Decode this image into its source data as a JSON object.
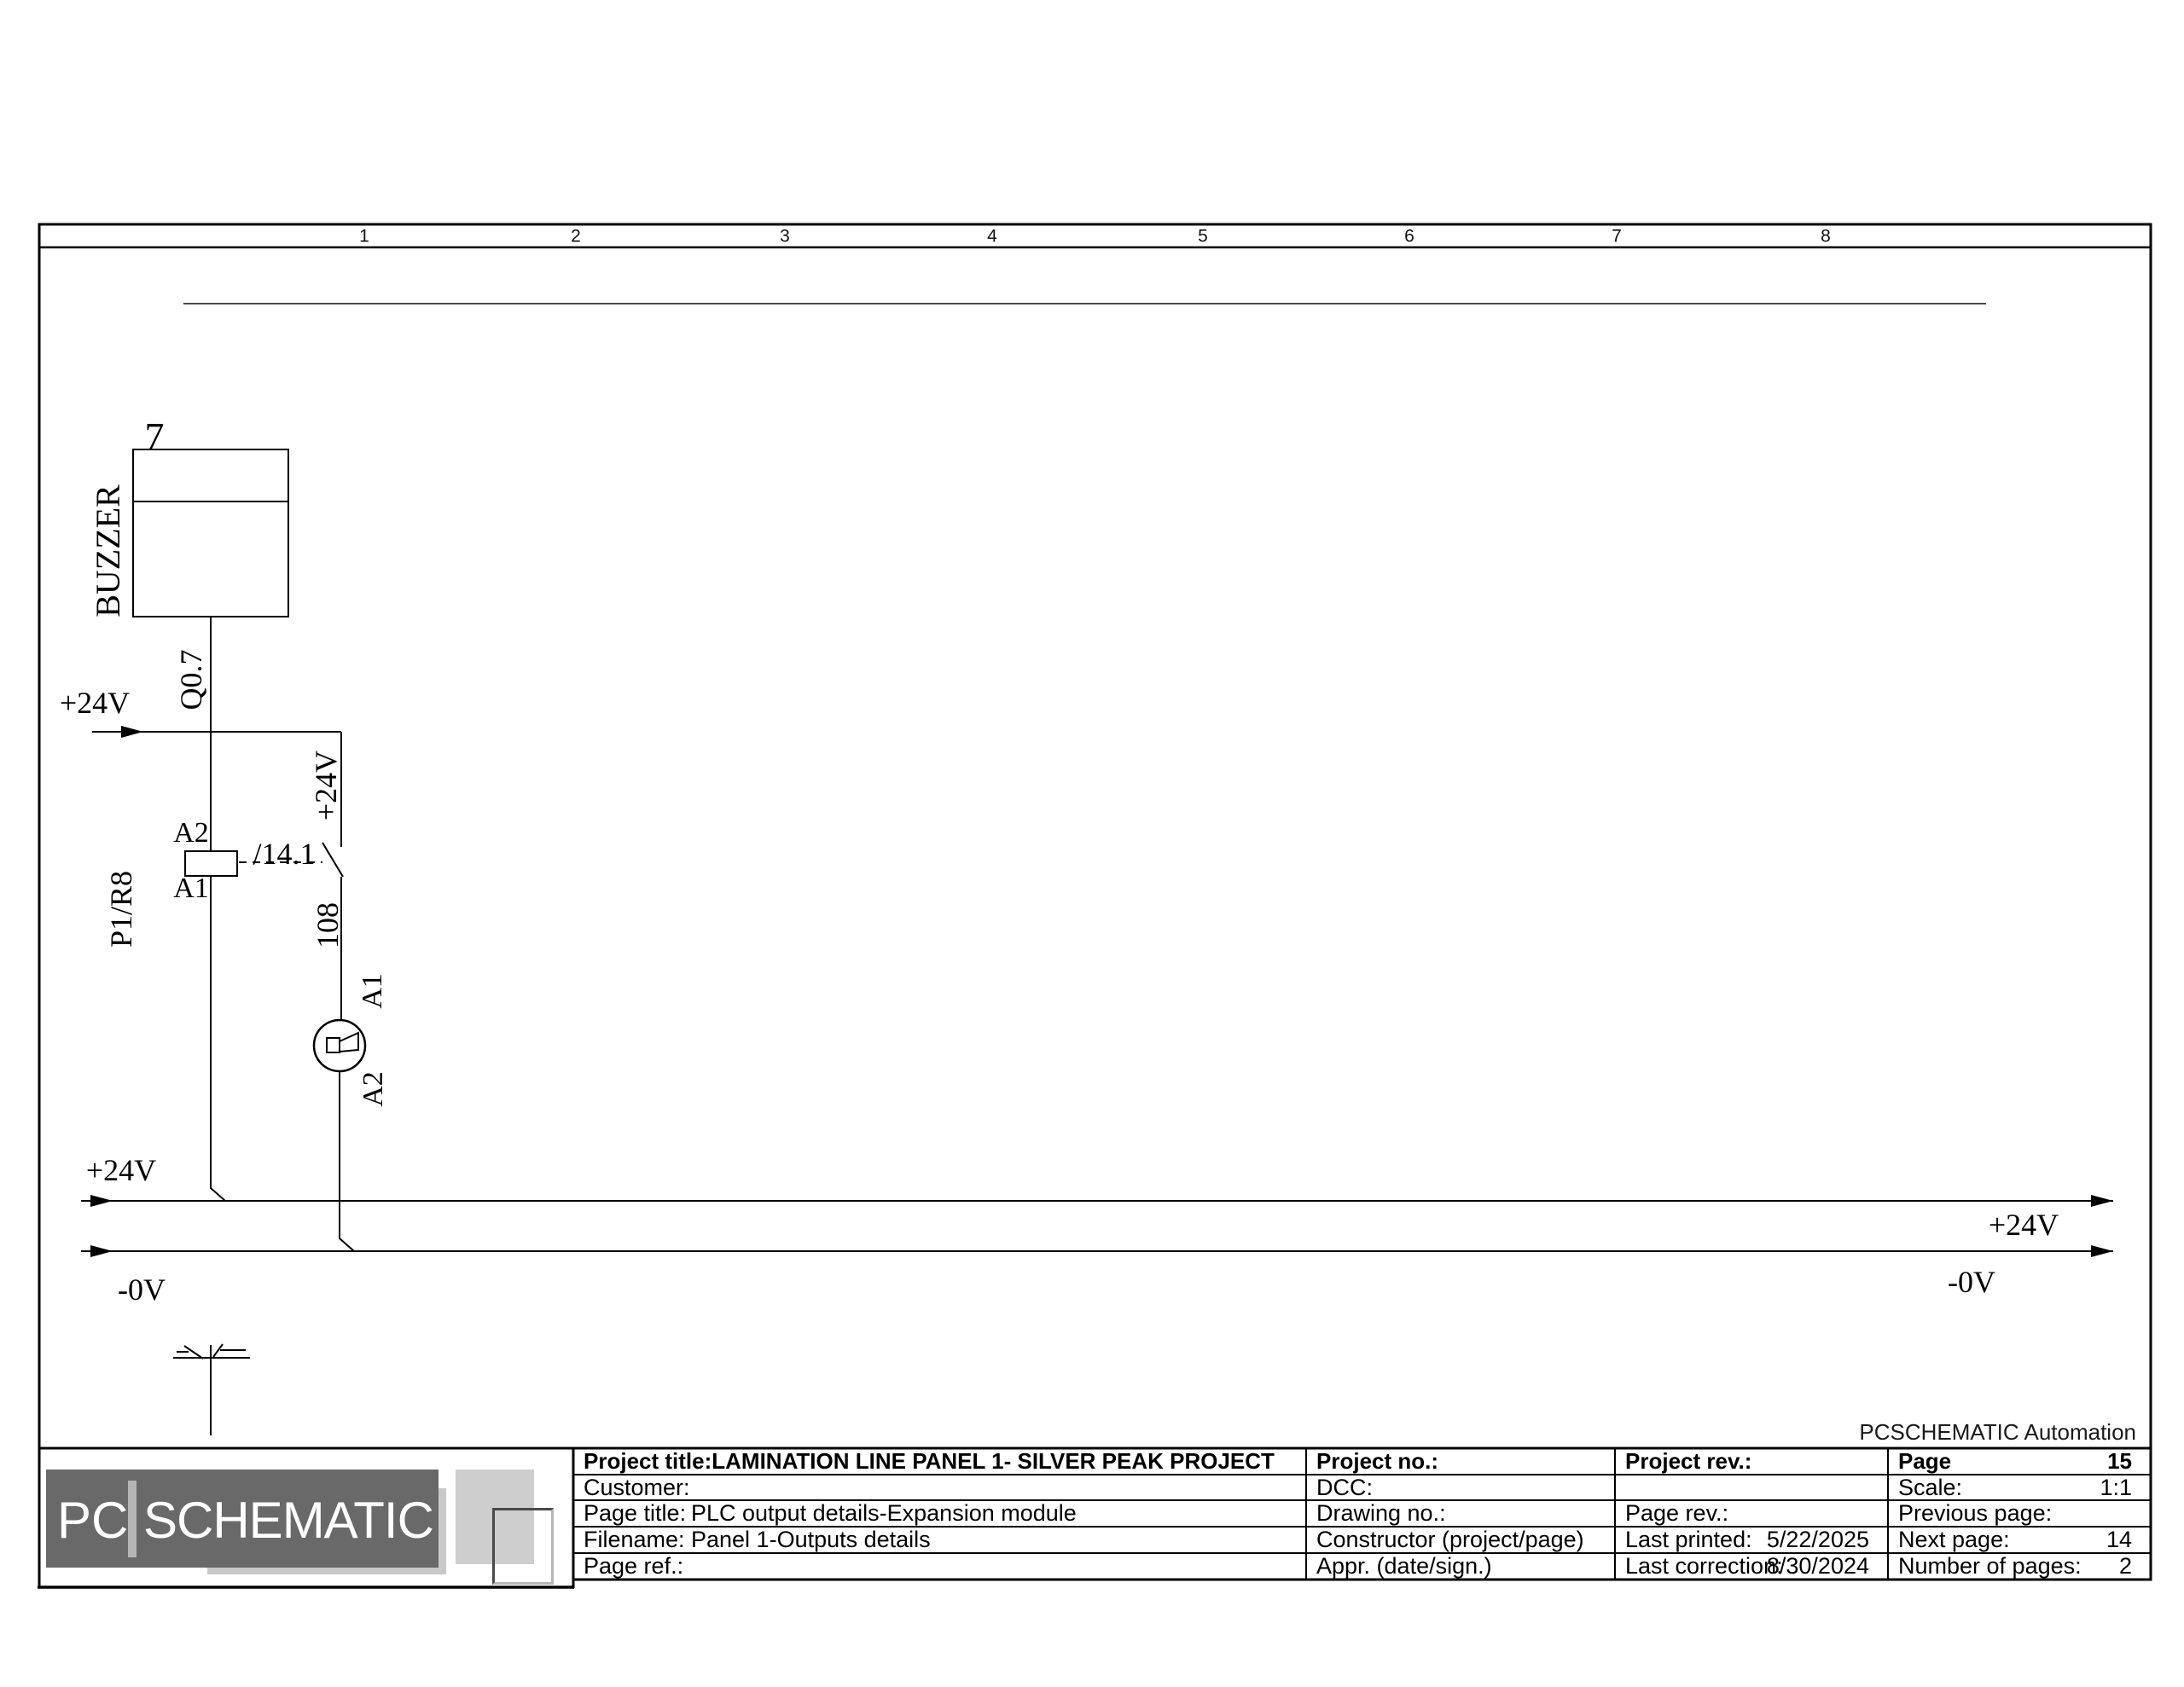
{
  "ruler": {
    "numbers": [
      "1",
      "2",
      "3",
      "4",
      "5",
      "6",
      "7",
      "8"
    ]
  },
  "schematic": {
    "buzzer": {
      "pin": "7",
      "name": "BUZZER",
      "signal": "Q0.7"
    },
    "supply_top": "+24V",
    "relay": {
      "name": "P1/R8",
      "pin_top": "A2",
      "pin_bottom": "A1",
      "crossref": "/14.1"
    },
    "branch": {
      "supply": "+24V",
      "wire_no": "108",
      "pin_top": "A1",
      "pin_bottom": "A2"
    },
    "rails": {
      "plus_left": "+24V",
      "plus_right": "+24V",
      "zero_left": "-0V",
      "zero_right": "-0V"
    }
  },
  "footer": {
    "brand_left": "PC",
    "brand_right": "SCHEMATIC",
    "automation": "PCSCHEMATIC Automation"
  },
  "title_block": {
    "project_title_label": "Project title:",
    "project_title": "LAMINATION LINE PANEL 1- SILVER PEAK PROJECT",
    "customer_label": "Customer:",
    "page_title_label": "Page title:",
    "page_title": "PLC  output details-Expansion module",
    "filename_label": "Filename:",
    "filename": "Panel 1-Outputs details",
    "page_ref_label": "Page ref.:",
    "project_no_label": "Project no.:",
    "dcc_label": "DCC:",
    "drawing_no_label": "Drawing no.:",
    "constructor_label": "Constructor (project/page)",
    "appr_label": "Appr. (date/sign.)",
    "project_rev_label": "Project rev.:",
    "page_rev_label": "Page rev.:",
    "last_printed_label": "Last printed:",
    "last_printed": "5/22/2025",
    "last_correction_label": "Last correction:",
    "last_correction": "8/30/2024",
    "page_label": "Page",
    "page": "15",
    "scale_label": "Scale:",
    "scale": "1:1",
    "previous_page_label": "Previous page:",
    "previous_page": "",
    "next_page_label": "Next page:",
    "next_page": "14",
    "num_pages_label": "Number of pages:",
    "num_pages": "2"
  }
}
